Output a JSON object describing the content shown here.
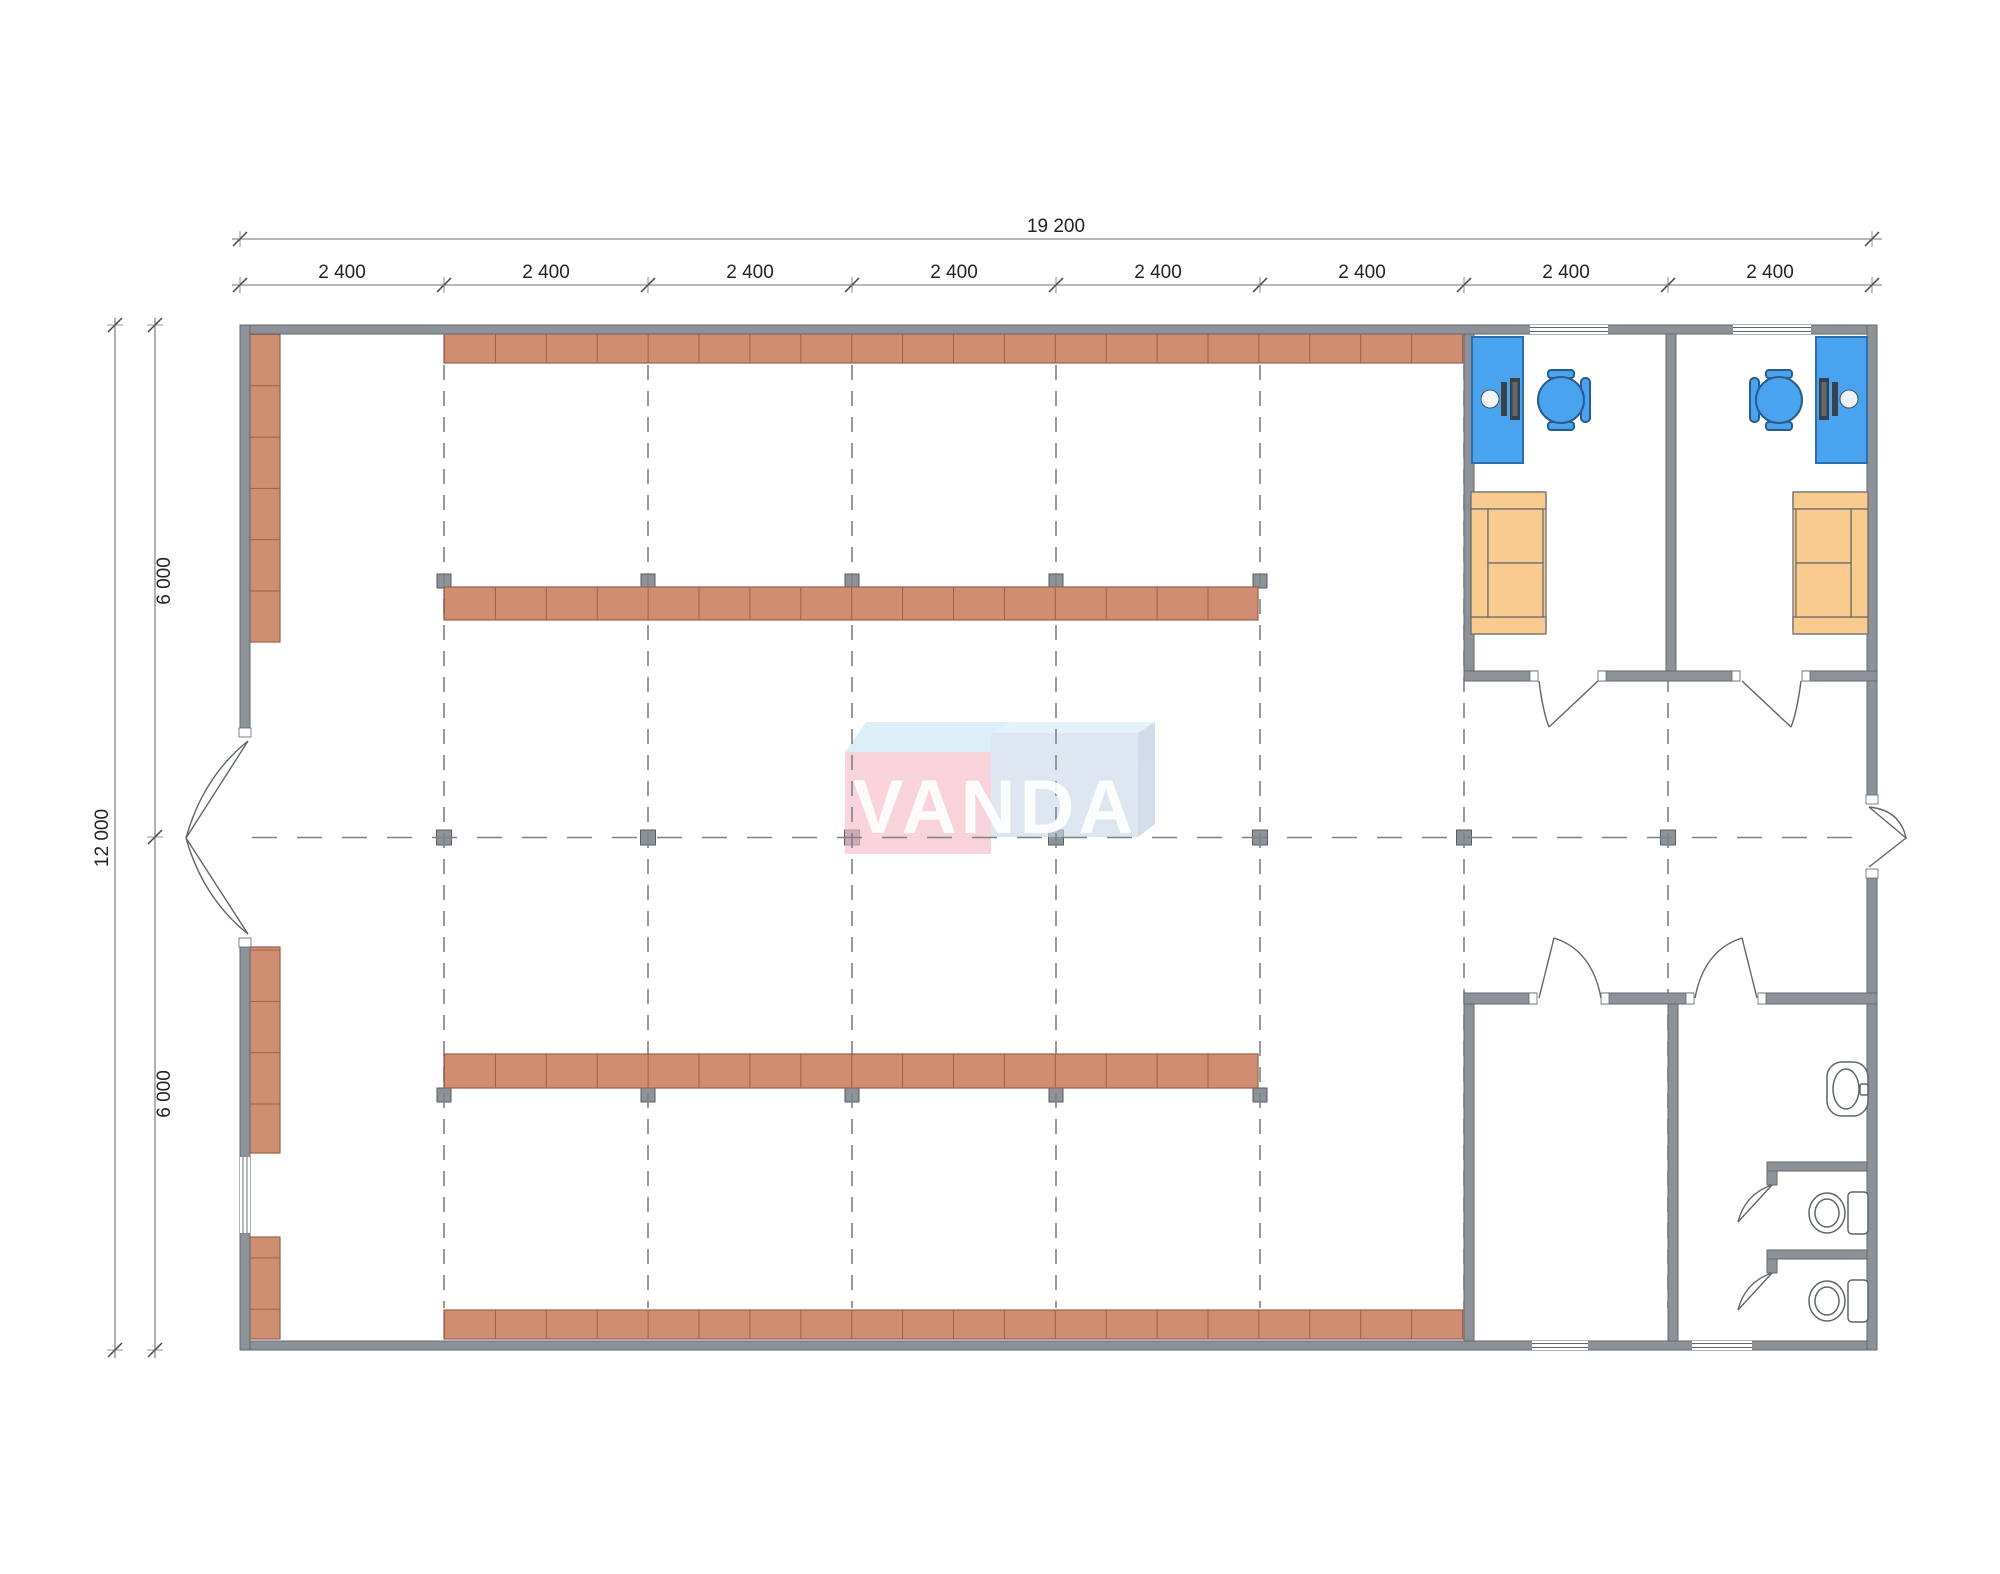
{
  "dimensions": {
    "top_total": "19 200",
    "top_segments": [
      "2 400",
      "2 400",
      "2 400",
      "2 400",
      "2 400",
      "2 400",
      "2 400",
      "2 400"
    ],
    "left_total": "12 000",
    "left_segments": [
      "6 000",
      "6 000"
    ]
  },
  "watermark": {
    "text": "VANDA",
    "pink_front": "#f5b9c6",
    "pink_top": "#c9e7f8",
    "blue_front": "#c9d7ea",
    "blue_top": "#d5ecfa",
    "blue_side": "#b6c6dd"
  },
  "colors": {
    "wall": "#8c9298",
    "wall_outline": "#63696f",
    "shelf": "#cf8e72",
    "shelf_line": "#9c5f49",
    "desk": "#4aa3ee",
    "chair": "#4aa3ee",
    "sofa": "#f8cb8f",
    "column": "#8d9499",
    "grid": "#7d8286",
    "dim_line": "#6f7478",
    "door_line": "#5f666b"
  }
}
